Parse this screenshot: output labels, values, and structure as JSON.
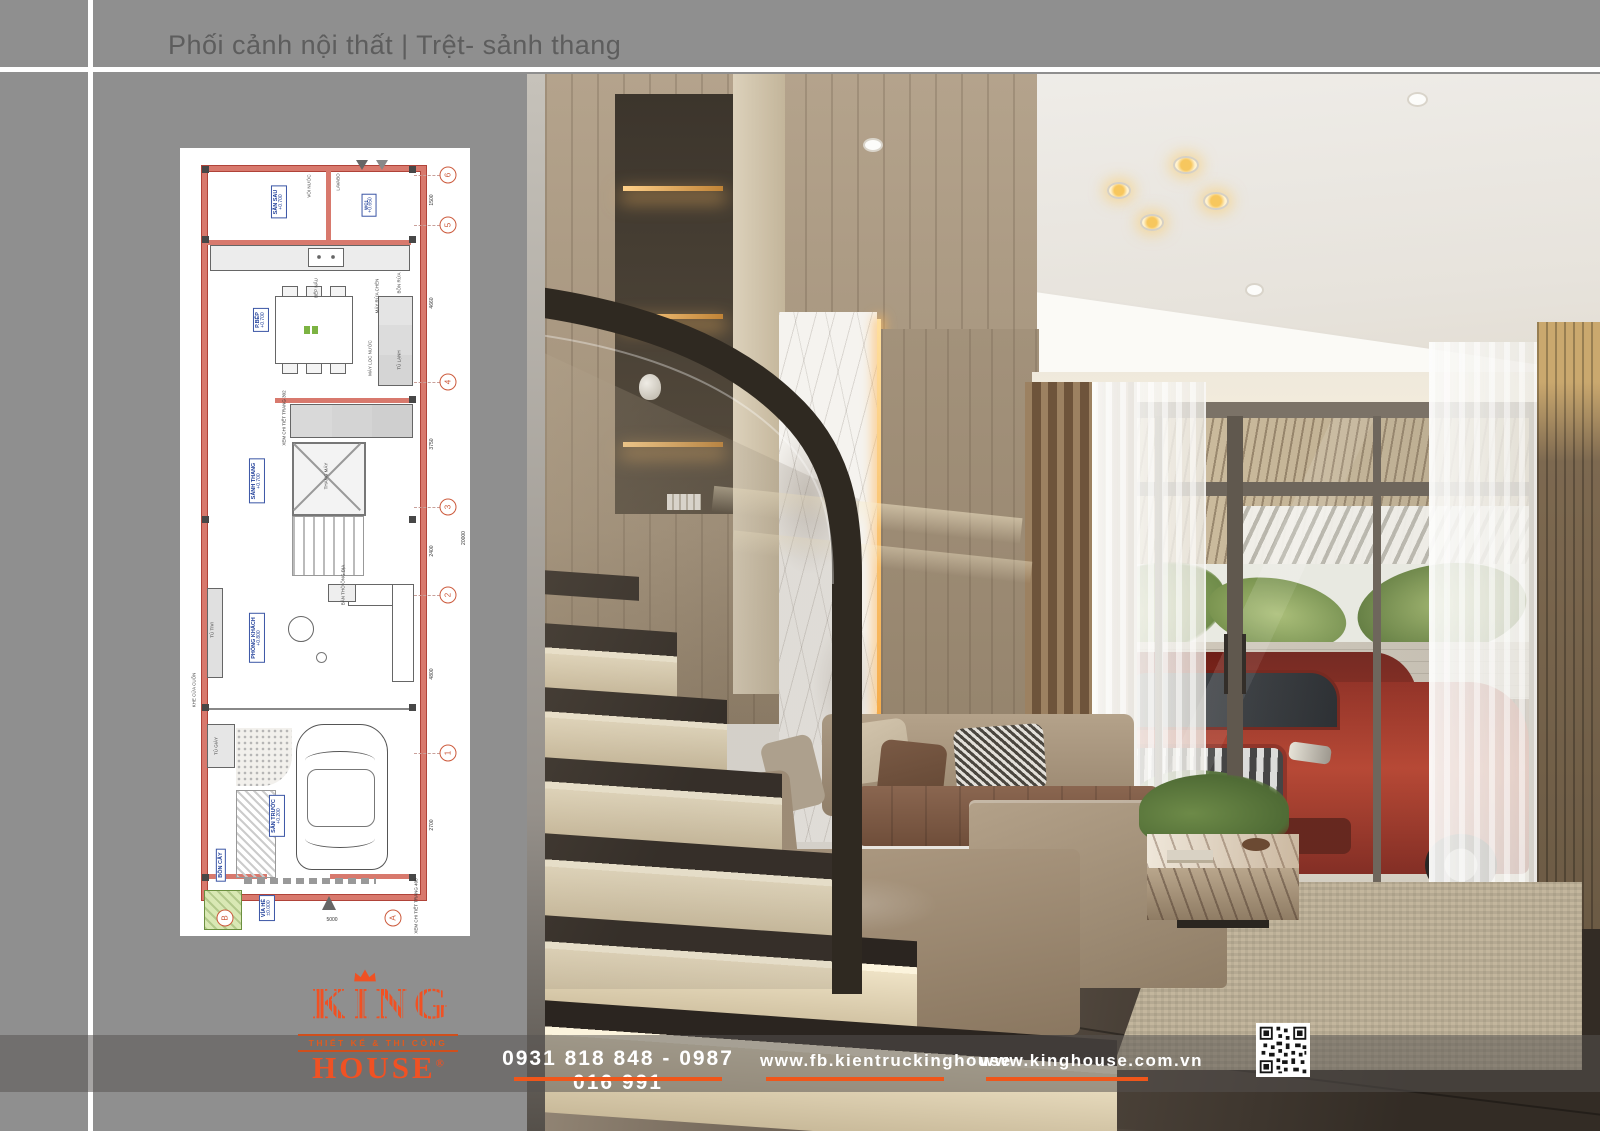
{
  "header": {
    "title": "Phối cảnh nội thất | Trệt- sảnh thang"
  },
  "floor_plan": {
    "rooms": [
      {
        "name": "SÂN SAU",
        "level": "+0.700"
      },
      {
        "name": "WC1",
        "level": "+0.650"
      },
      {
        "name": "P.BẾP",
        "level": "+0.700"
      },
      {
        "name": "SẢNH THANG",
        "level": "+0.700"
      },
      {
        "name": "PHÒNG KHÁCH",
        "level": "+0.800"
      },
      {
        "name": "SÂN TRƯỚC",
        "level": "+0.200"
      },
      {
        "name": "VỈA HÈ",
        "level": "±0.000"
      },
      {
        "name": "BỒN CÂY",
        "level": ""
      }
    ],
    "fixtures": [
      "VÒI NƯỚC",
      "LAVABO",
      "BẾP NẤU",
      "MÁY RỬA CHÉN",
      "BỒN RỬA",
      "MÁY LỌC NƯỚC",
      "TỦ LẠNH",
      "THANG MÁY",
      "KHE CỬA CUỐN",
      "TỦ GIÀY",
      "TỦ TIVI",
      "BÀN THỜ ÔNG ĐỊA"
    ],
    "notes": [
      "XEM CHI TIẾT TRANG 302",
      "XEM CHI TIẾT TRANG 408"
    ],
    "grid_rows": [
      "6",
      "5",
      "4",
      "3",
      "2",
      "1"
    ],
    "grid_cols": [
      "B",
      "A"
    ],
    "dims_right": [
      "1500",
      "4660",
      "3750",
      "2400",
      "4800",
      "2700"
    ],
    "dim_total": "20000",
    "dim_bottom": "5000"
  },
  "footer": {
    "phone": "0931 818 848 - 0987 016 991",
    "facebook": "www.fb.kientruckinghouse",
    "website": "www.kinghouse.com.vn"
  },
  "logo": {
    "brand": "KING",
    "tagline": "THIẾT KẾ & THI CÔNG",
    "brand2": "HOUSE",
    "registered": "®"
  },
  "colors": {
    "accent_orange": "#F05123",
    "underline_orange": "#F0561A",
    "page_background": "#8F8F8F",
    "title_text": "#5D5D5D",
    "plan_wall_red": "#D8796D",
    "plan_label_blue": "#21409A"
  }
}
